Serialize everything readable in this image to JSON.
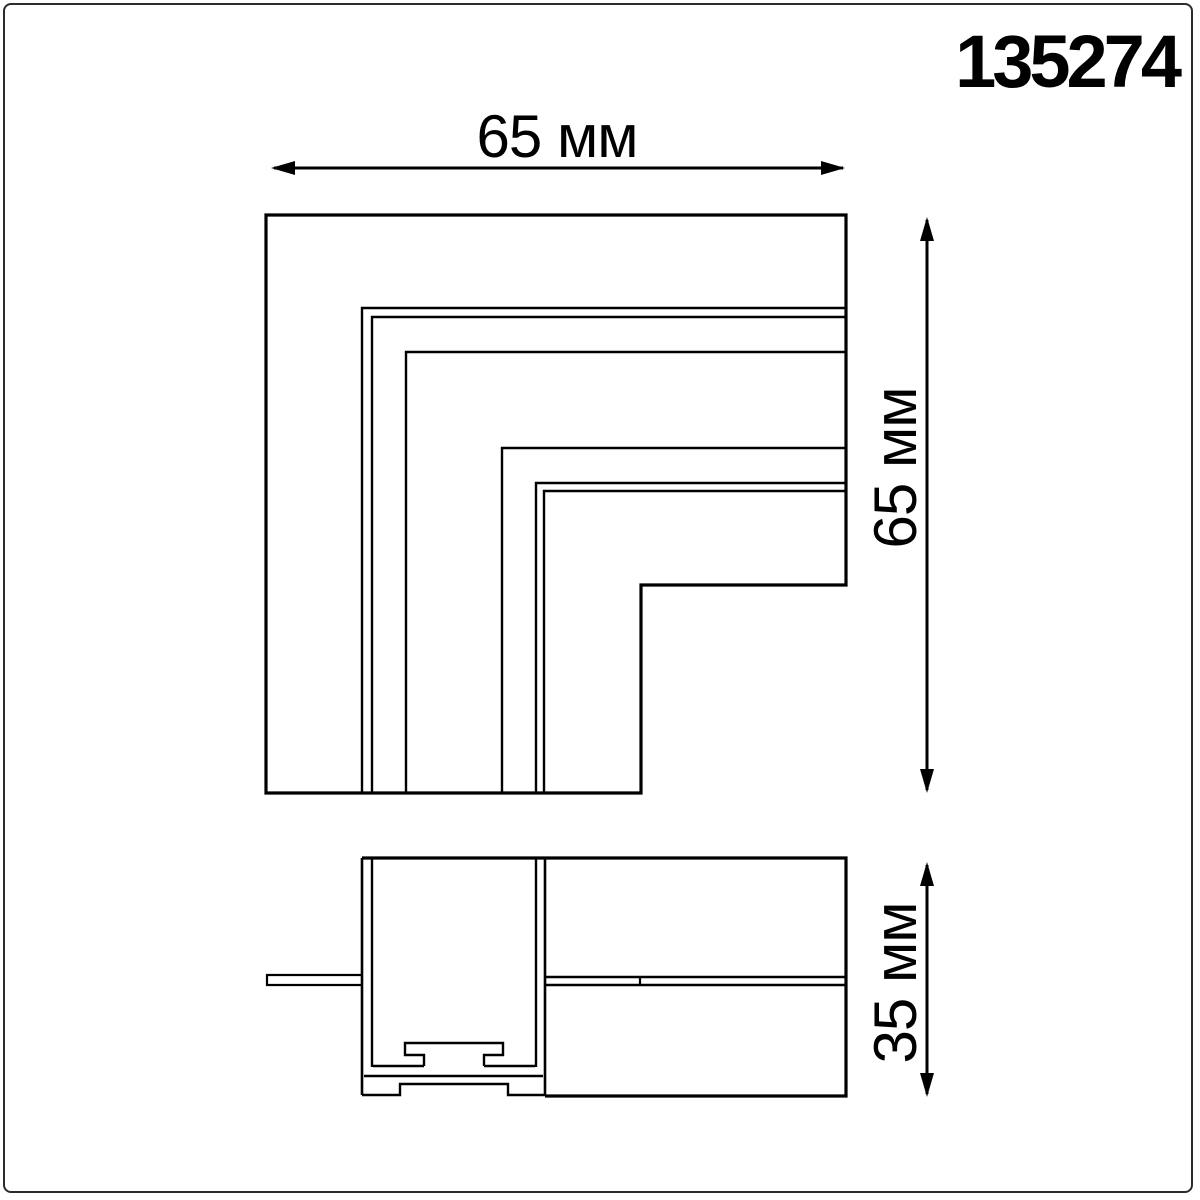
{
  "product_code": "135274",
  "dimensions": {
    "top_width": "65 мм",
    "side_height": "65 мм",
    "section_height": "35 мм"
  },
  "colors": {
    "line": "#000000",
    "frame_border": "#2b2b2b",
    "background": "#ffffff"
  }
}
